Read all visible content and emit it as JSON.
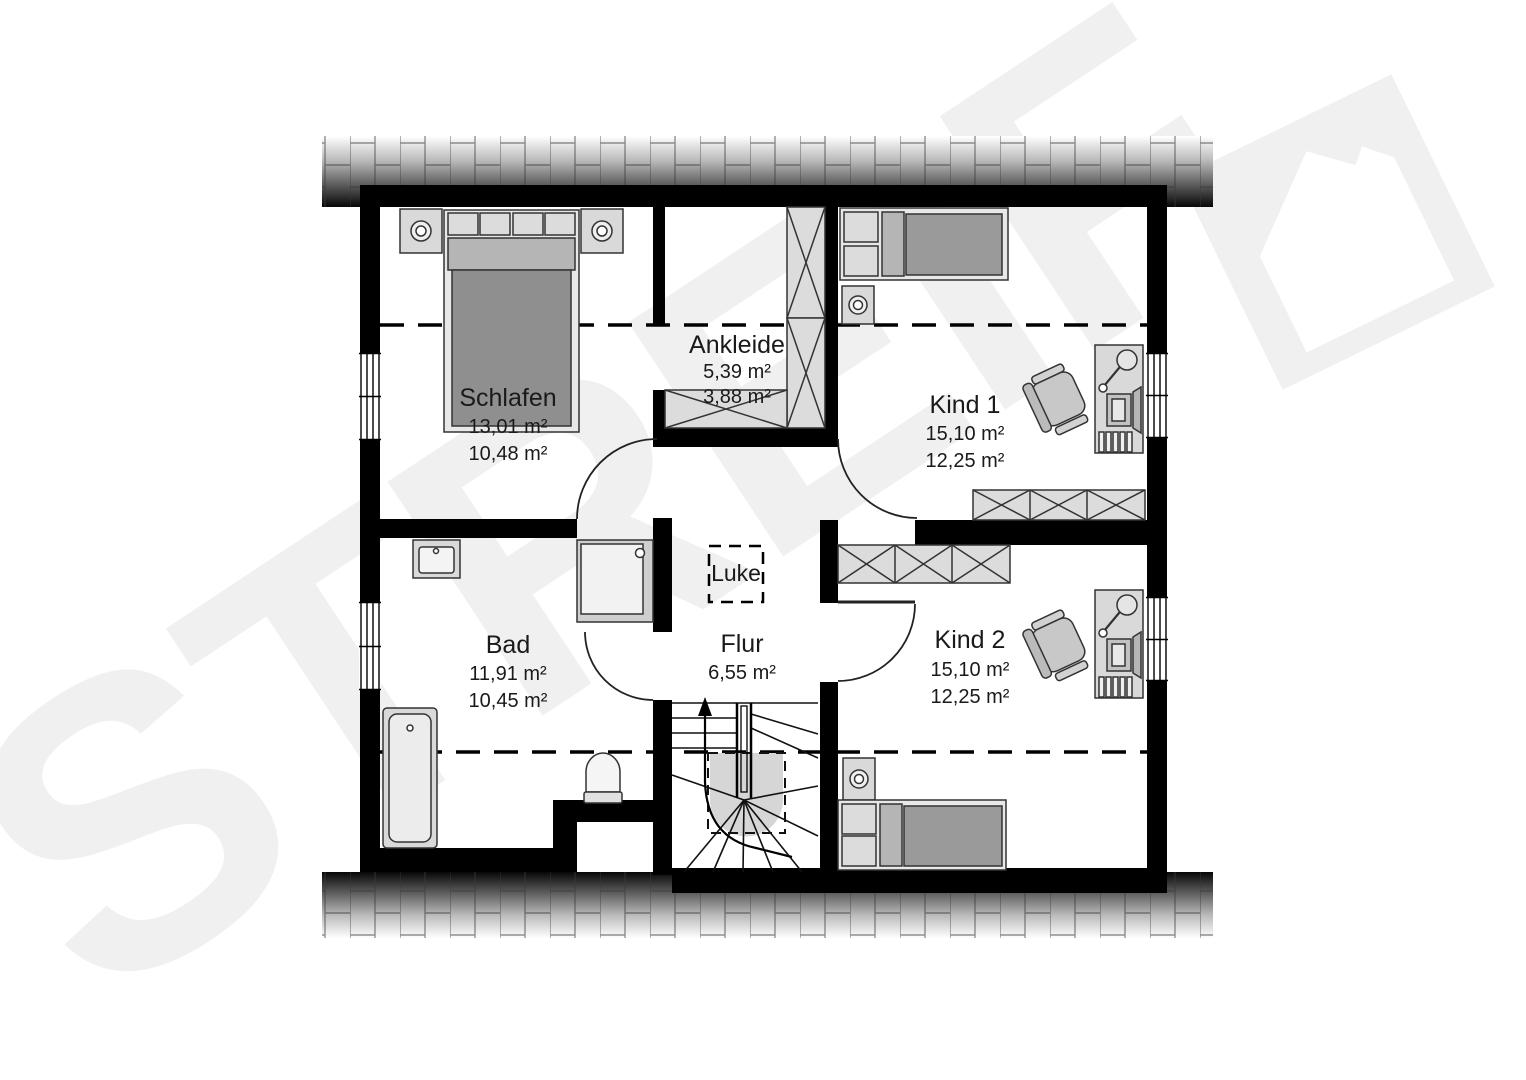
{
  "watermark": {
    "text": "STREIF",
    "color": "#f0f0f0"
  },
  "luke": {
    "label": "Luke"
  },
  "rooms": [
    {
      "id": "schlafen",
      "label": "Schlafen",
      "area_living": "13,01 m²",
      "area_floor": "10,48 m²"
    },
    {
      "id": "ankleide",
      "label": "Ankleide",
      "area_living": "5,39 m²",
      "area_floor": "3,88 m²"
    },
    {
      "id": "kind1",
      "label": "Kind 1",
      "area_living": "15,10 m²",
      "area_floor": "12,25 m²"
    },
    {
      "id": "kind2",
      "label": "Kind 2",
      "area_living": "15,10 m²",
      "area_floor": "12,25 m²"
    },
    {
      "id": "bad",
      "label": "Bad",
      "area_living": "11,91 m²",
      "area_floor": "10,45 m²"
    },
    {
      "id": "flur",
      "label": "Flur",
      "area_living": "6,55 m²"
    }
  ],
  "colors": {
    "wall": "#000000",
    "furniture_light": "#d9d9d9",
    "furniture_mid": "#b5b5b5",
    "furniture_dark": "#8f8f8f",
    "watermark": "#f0f0f0",
    "text": "#1a1a1a"
  }
}
